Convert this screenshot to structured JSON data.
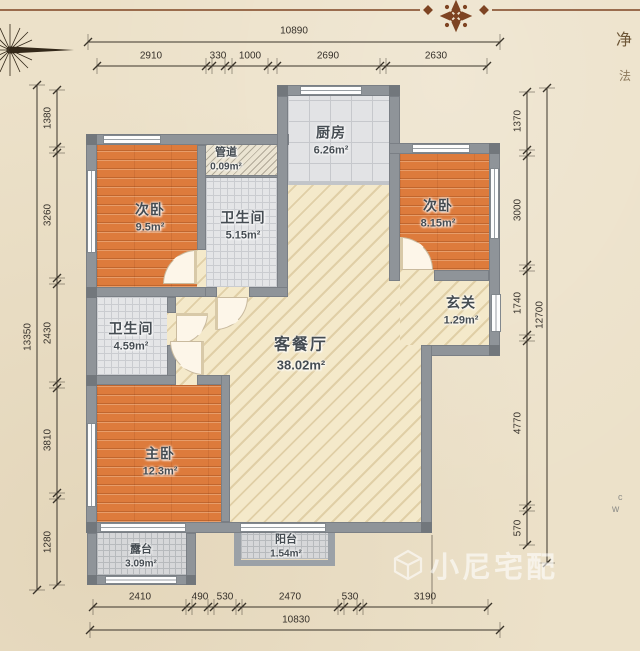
{
  "plan": {
    "rooms": {
      "bedroom_left": {
        "name": "次卧",
        "area": "9.5m²"
      },
      "duct": {
        "name": "管道",
        "area": "0.09m²"
      },
      "bath_top": {
        "name": "卫生间",
        "area": "5.15m²"
      },
      "kitchen": {
        "name": "厨房",
        "area": "6.26m²"
      },
      "bedroom_right": {
        "name": "次卧",
        "area": "8.15m²"
      },
      "foyer": {
        "name": "玄关",
        "area": "1.29m²"
      },
      "living": {
        "name": "客餐厅",
        "area": "38.02m²"
      },
      "bath_mid": {
        "name": "卫生间",
        "area": "4.59m²"
      },
      "master": {
        "name": "主卧",
        "area": "12.3m²"
      },
      "terrace": {
        "name": "露台",
        "area": "3.09m²"
      },
      "balcony": {
        "name": "阳台",
        "area": "1.54m²"
      }
    }
  },
  "dimensions": {
    "top": {
      "total": "10890",
      "segments": [
        "2910",
        "330",
        "1000",
        "2690",
        "2630"
      ]
    },
    "bottom": {
      "total": "10830",
      "segments": [
        "2410",
        "490",
        "530",
        "2470",
        "530",
        "3190"
      ]
    },
    "left": {
      "total": "13350",
      "segments": [
        "1380",
        "3260",
        "2430",
        "3810",
        "1280"
      ]
    },
    "right": {
      "total": "12700",
      "segments": [
        "1370",
        "3000",
        "1740",
        "4770",
        "570"
      ]
    }
  },
  "watermark": {
    "icon": "cube-logo",
    "text": "小尼宅配"
  },
  "edge_text": {
    "top_right_upper": "净",
    "top_right_lower": "法",
    "bottom_right_upper": "c",
    "bottom_right_lower": "w"
  },
  "colors": {
    "paper": "#ece1c9",
    "wall": "#8f9499",
    "wood": "#dd7b3c",
    "tile": "#e4e5e7",
    "hatch_floor": "#f4e9ca",
    "ornament": "#7e4423"
  }
}
